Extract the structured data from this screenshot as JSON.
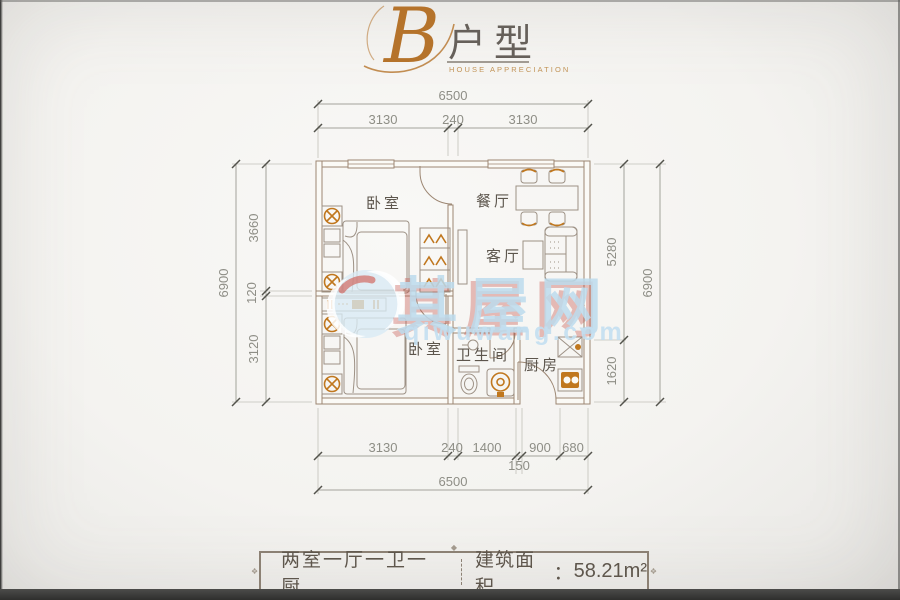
{
  "header": {
    "letter": "B",
    "title": "户型",
    "subtitle": "HOUSE APPRECIATION"
  },
  "rooms": {
    "bedroom1": "卧室",
    "dining": "餐厅",
    "living": "客厅",
    "bedroom2": "卧室",
    "bathroom": "卫生间",
    "kitchen": "厨房"
  },
  "dims": {
    "top_total": "6500",
    "top_a": "3130",
    "top_b": "240",
    "top_c": "3130",
    "left_total": "6900",
    "left_a": "3660",
    "left_b": "120",
    "left_c": "3120",
    "right_a": "5280",
    "right_b": "1620",
    "right_total": "6900",
    "bot_a": "3130",
    "bot_b": "240",
    "bot_c": "1400",
    "bot_d": "900",
    "bot_e": "680",
    "bot_inset": "150",
    "bot_total": "6500"
  },
  "watermark": {
    "name": "其屋网",
    "url": "qiwuwang.com"
  },
  "footer": {
    "layout": "两室一厅一卫一厨",
    "area_label": "建筑面积",
    "colon": "：",
    "area_value": "58.21m²"
  },
  "colors": {
    "accent_orange": "#c0771e",
    "wall_line": "#9c8672",
    "dim_line": "#8f8f87",
    "text_dark": "#5e564c",
    "watermark_blue": "#bcdaec",
    "watermark_red": "#c65850",
    "header_gold": "#b5732b",
    "photo_bg": "#f4f3f0"
  }
}
